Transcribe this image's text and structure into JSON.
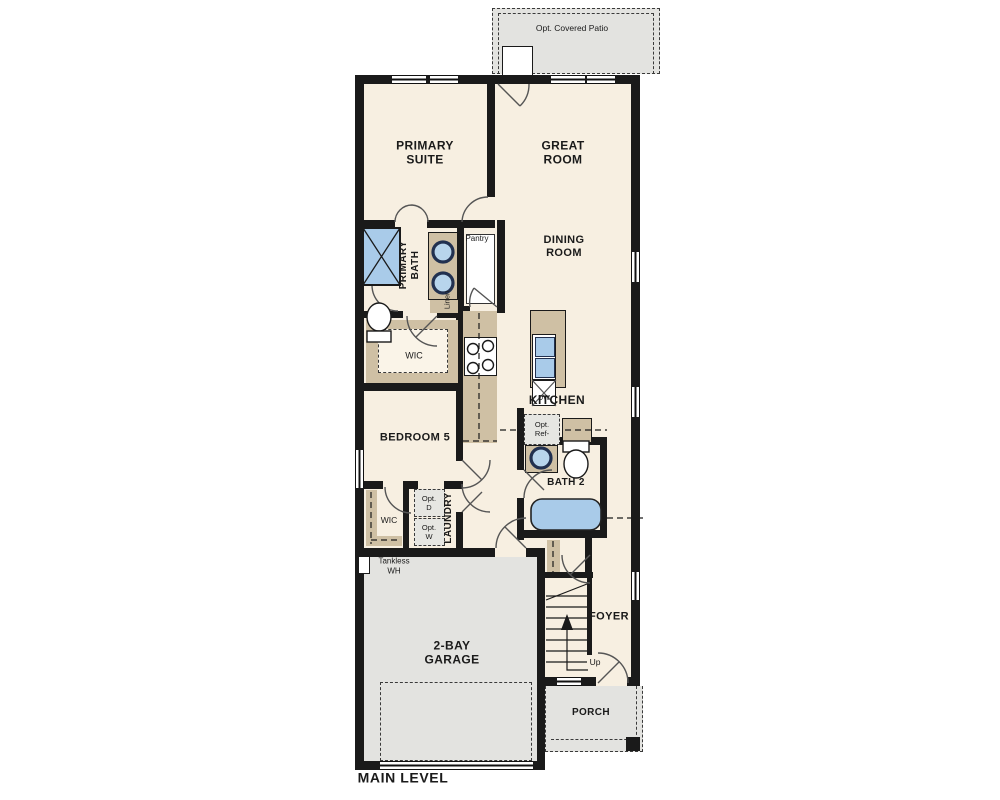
{
  "title": "MAIN LEVEL",
  "colors": {
    "wall": "#1a1a1a",
    "floor": "#f7efe1",
    "concrete_gray": "#e3e3e0",
    "casework_tan": "#cfc0a4",
    "fixture_blue": "#a9cbe9",
    "sink_rim": "#223150"
  },
  "areas": {
    "patio": {
      "label": "Opt. Covered Patio"
    },
    "primary_suite": {
      "line1": "PRIMARY",
      "line2": "SUITE"
    },
    "great_room": {
      "line1": "GREAT",
      "line2": "ROOM"
    },
    "primary_bath": {
      "line1": "PRIMARY",
      "line2": "BATH"
    },
    "pantry": {
      "label": "Pantry"
    },
    "dining_room": {
      "line1": "DINING",
      "line2": "ROOM"
    },
    "linen": {
      "label": "Linen"
    },
    "wic_primary": {
      "label": "WIC"
    },
    "kitchen": {
      "label": "KITCHEN"
    },
    "opt_ref": {
      "line1": "Opt.",
      "line2": "Ref-"
    },
    "bedroom5": {
      "label": "BEDROOM 5"
    },
    "wic_bedroom5": {
      "label": "WIC"
    },
    "laundry": {
      "label": "LAUNDRY"
    },
    "opt_dryer": {
      "line1": "Opt.",
      "line2": "D"
    },
    "opt_washer": {
      "line1": "Opt.",
      "line2": "W"
    },
    "bath2": {
      "label": "BATH 2"
    },
    "tankless": {
      "line1": "Tankless",
      "line2": "WH"
    },
    "garage": {
      "line1": "2-BAY",
      "line2": "GARAGE"
    },
    "foyer": {
      "label": "FOYER"
    },
    "stairs": {
      "label": "Up"
    },
    "porch": {
      "label": "PORCH"
    },
    "dishwasher": {
      "label": "DW"
    },
    "plan_title": {
      "label": "MAIN LEVEL"
    }
  }
}
